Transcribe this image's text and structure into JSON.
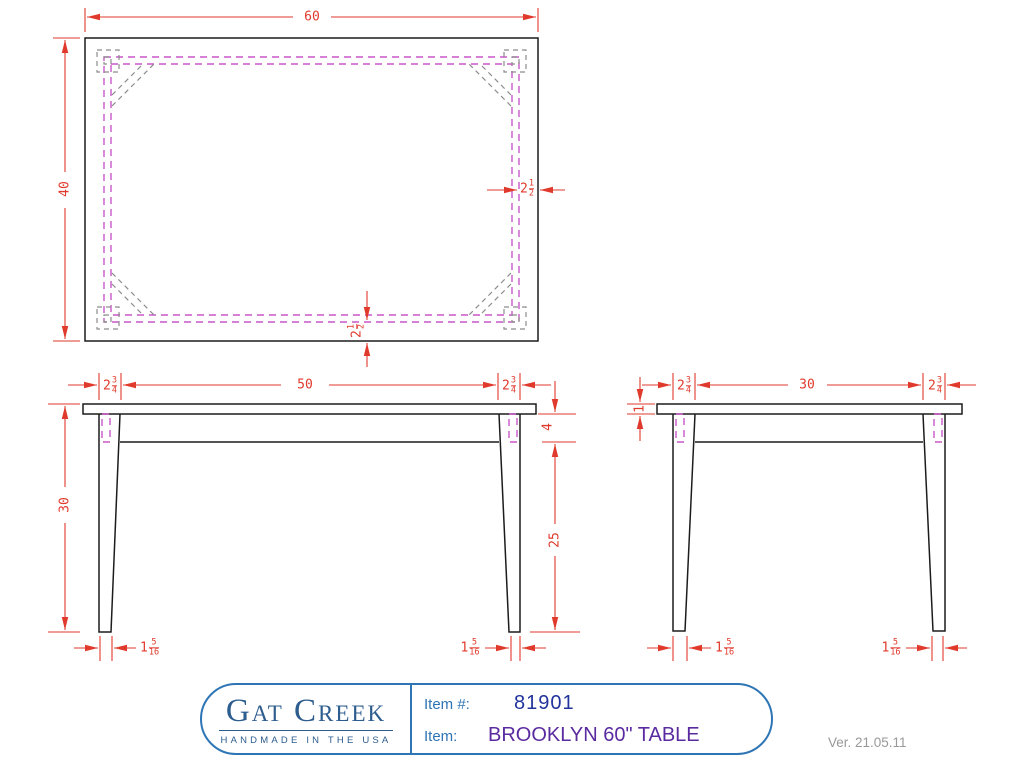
{
  "colors": {
    "dimension": "#e03a2c",
    "outline": "#1c1c1c",
    "apron_hidden": "#c957c9",
    "hidden_gray": "#8c8c8c",
    "title_border": "#2e75b6",
    "logo": "#2d5c8e",
    "item_label": "#2e74b5",
    "item_number": "#22349c",
    "item_name": "#5a2ba0",
    "version": "#999999"
  },
  "views": {
    "plan": {
      "width": "60",
      "depth": "40",
      "apron_inset_side": {
        "whole": "2",
        "num": "1",
        "den": "2"
      },
      "apron_inset_bottom": {
        "whole": "2",
        "num": "1",
        "den": "2"
      }
    },
    "front": {
      "leg_width_left": {
        "whole": "2",
        "num": "3",
        "den": "4"
      },
      "leg_span": "50",
      "leg_width_right": {
        "whole": "2",
        "num": "3",
        "den": "4"
      },
      "overall_height": "30",
      "apron_height": "4",
      "leg_clearance": "25",
      "foot_left": {
        "whole": "1",
        "num": "5",
        "den": "16"
      },
      "foot_right": {
        "whole": "1",
        "num": "5",
        "den": "16"
      }
    },
    "side": {
      "leg_width_left": {
        "whole": "2",
        "num": "3",
        "den": "4"
      },
      "leg_span": "30",
      "leg_width_right": {
        "whole": "2",
        "num": "3",
        "den": "4"
      },
      "top_thickness": "1",
      "foot_left": {
        "whole": "1",
        "num": "5",
        "den": "16"
      },
      "foot_right": {
        "whole": "1",
        "num": "5",
        "den": "16"
      }
    }
  },
  "title_block": {
    "logo_name": "Gat Creek",
    "logo_tagline": "HANDMADE IN THE USA",
    "item_number_label": "Item #:",
    "item_number": "81901",
    "item_label": "Item:",
    "item_name": "BROOKLYN 60\" TABLE"
  },
  "version_note": "Ver. 21.05.11"
}
